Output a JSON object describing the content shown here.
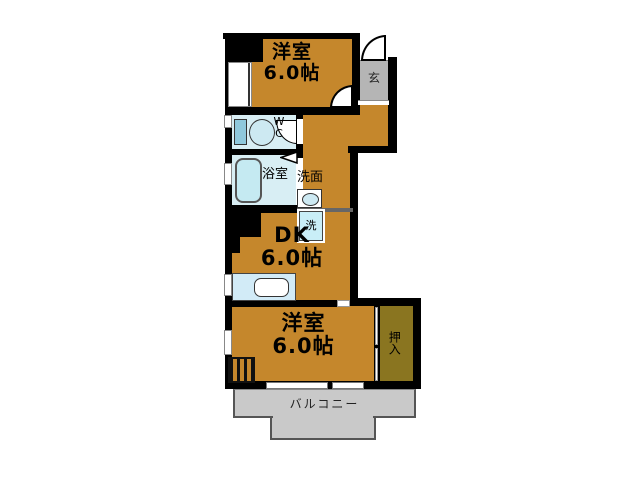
{
  "floorplan": {
    "rooms": {
      "western_top": {
        "name": "洋室",
        "size": "6.0帖"
      },
      "dining_kitchen": {
        "name": "DK",
        "size": "6.0帖"
      },
      "western_bottom": {
        "name": "洋室",
        "size": "6.0帖"
      },
      "entrance": {
        "label": "玄"
      },
      "toilet": {
        "label_w": "W",
        "label_c": "C"
      },
      "bathroom": {
        "label": "浴室"
      },
      "washroom": {
        "label": "洗面"
      },
      "washer": {
        "label": "洗"
      },
      "closet": {
        "label": "押入"
      },
      "balcony": {
        "label": "バルコニー"
      }
    },
    "colors": {
      "room_floor": "#C5872C",
      "closet_floor": "#8A7520",
      "entrance_floor": "#B5B5B5",
      "balcony_floor": "#C9C9C9",
      "wet_area_floor": "#D8EEF4",
      "fixture_blue": "#C9E9F4",
      "wall": "#000000",
      "background": "#FFFFFF"
    }
  }
}
